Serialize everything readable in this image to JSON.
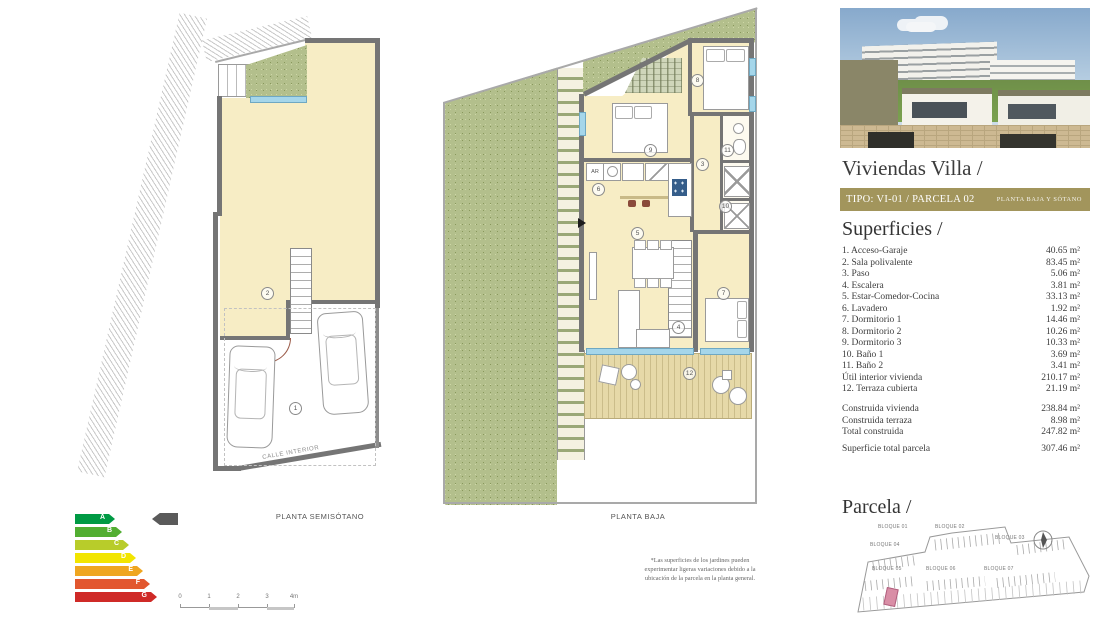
{
  "panel": {
    "title": "Viviendas Villa /",
    "banner": {
      "type_label": "TIPO: VI-01 / PARCELA 02",
      "floor_label": "PLANTA BAJA Y SÓTANO",
      "bg_color": "#a2955c"
    },
    "superficies": {
      "heading": "Superficies /",
      "rows": [
        {
          "label": "1. Acceso-Garaje",
          "value": "40.65 m²"
        },
        {
          "label": "2. Sala polivalente",
          "value": "83.45 m²"
        },
        {
          "label": "3. Paso",
          "value": "5.06 m²"
        },
        {
          "label": "4. Escalera",
          "value": "3.81 m²"
        },
        {
          "label": "5. Estar-Comedor-Cocina",
          "value": "33.13 m²"
        },
        {
          "label": "6. Lavadero",
          "value": "1.92 m²"
        },
        {
          "label": "7. Dormitorio 1",
          "value": "14.46 m²"
        },
        {
          "label": "8. Dormitorio 2",
          "value": "10.26 m²"
        },
        {
          "label": "9. Dormitorio 3",
          "value": "10.33 m²"
        },
        {
          "label": "10. Baño 1",
          "value": "3.69 m²"
        },
        {
          "label": "11. Baño 2",
          "value": "3.41 m²"
        },
        {
          "label": "Útil interior vivienda",
          "value": "210.17 m²"
        },
        {
          "label": "12. Terraza cubierta",
          "value": "21.19 m²"
        }
      ],
      "construida": [
        {
          "label": "Construida vivienda",
          "value": "238.84 m²"
        },
        {
          "label": "Construida terraza",
          "value": "8.98 m²"
        },
        {
          "label": "Total construida",
          "value": "247.82 m²"
        }
      ],
      "total": {
        "label": "Superficie total parcela",
        "value": "307.46 m²"
      }
    },
    "parcela": {
      "heading": "Parcela /",
      "blocks": [
        "BLOQUE 01",
        "BLOQUE 02",
        "BLOQUE 03",
        "BLOQUE 04",
        "BLOQUE 05",
        "BLOQUE 06",
        "BLOQUE 07"
      ],
      "highlight_color": "#d98ea6"
    }
  },
  "plans": {
    "semisotano": {
      "caption": "PLANTA SEMISÓTANO",
      "street": "CALLE INTERIOR",
      "labels": [
        "1",
        "2"
      ]
    },
    "baja": {
      "caption": "PLANTA BAJA",
      "kitchen_tag": "AR",
      "labels": [
        "3",
        "4",
        "5",
        "6",
        "7",
        "8",
        "9",
        "10",
        "11",
        "12"
      ],
      "footnote": "*Las superficies de los jardines pueden experimentar ligeras variaciones debido a la ubicación de la parcela en la planta general."
    }
  },
  "energy": {
    "ratings": [
      {
        "label": "A",
        "color": "#009a44"
      },
      {
        "label": "B",
        "color": "#52ae32"
      },
      {
        "label": "C",
        "color": "#b8cc2a"
      },
      {
        "label": "D",
        "color": "#f2e500"
      },
      {
        "label": "E",
        "color": "#efa620"
      },
      {
        "label": "F",
        "color": "#e2572f"
      },
      {
        "label": "G",
        "color": "#cf2a27"
      }
    ],
    "pointer_color": "#5a5a5a"
  },
  "scalebar": {
    "ticks": [
      "0",
      "1",
      "2",
      "3",
      "4m"
    ]
  }
}
